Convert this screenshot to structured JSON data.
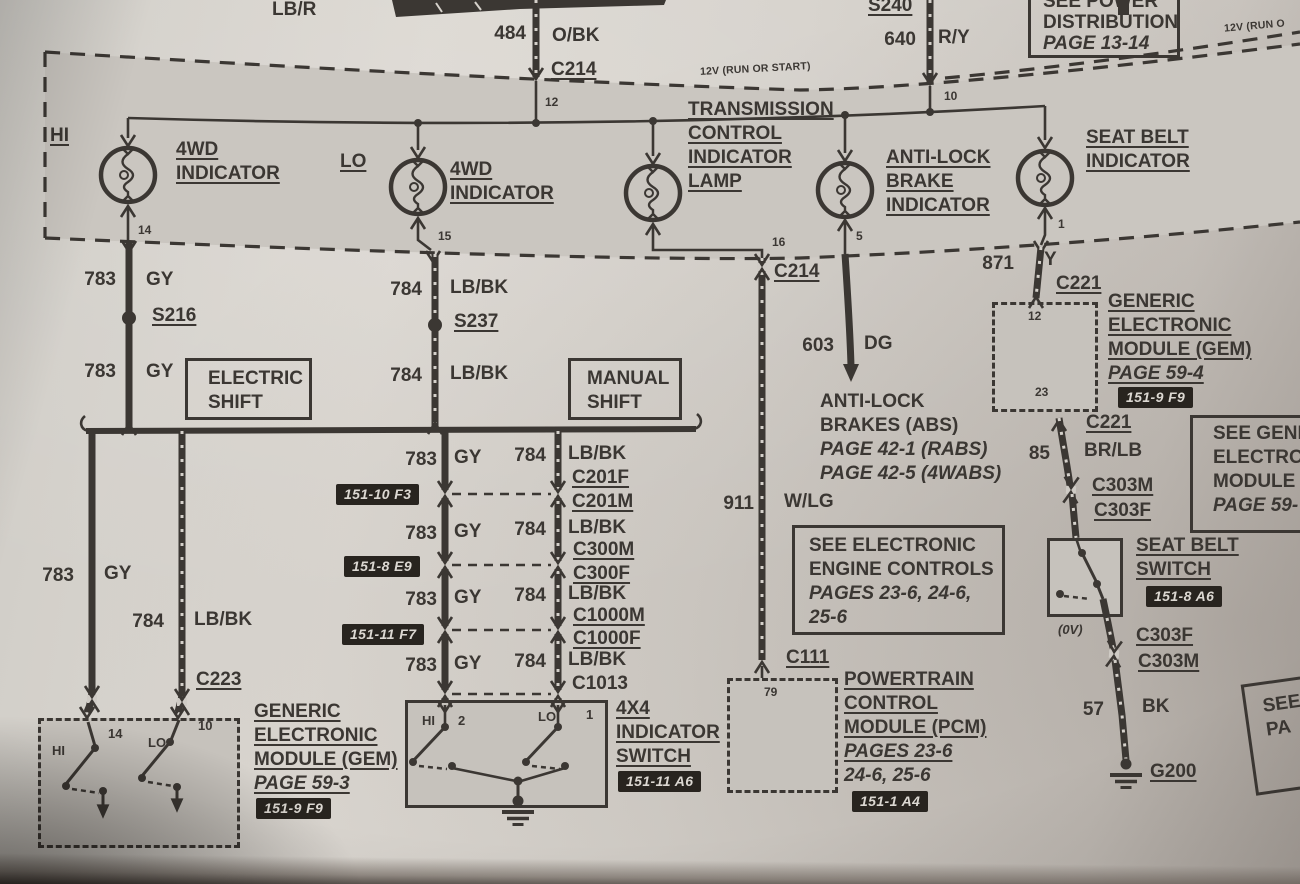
{
  "palette": {
    "paper": "#d7d3cd",
    "ink": "#3b3733",
    "panel": "#c6c2bc",
    "badge_bg": "#28241f",
    "badge_text": "#dcd8d2"
  },
  "top": {
    "lb_r": "LB/R",
    "s240": "S240",
    "w484_num": "484",
    "w484_color": "O/BK",
    "c214": "C214",
    "w640_num": "640",
    "w640_color": "R/Y",
    "power_box": [
      "SEE POWER",
      "DISTRIBUTION",
      "PAGE 13-14"
    ],
    "feed_left": "12V (RUN OR START)",
    "feed_right": "12V (RUN O"
  },
  "cluster": {
    "pin12": "12",
    "pin10": "10",
    "pin14": "14",
    "pin15": "15",
    "pin16": "16",
    "pin5": "5",
    "pin1": "1",
    "hi": "HI",
    "lo": "LO",
    "lamp_4wd_hi": [
      "4WD",
      "INDICATOR"
    ],
    "lamp_4wd_lo": [
      "4WD",
      "INDICATOR"
    ],
    "lamp_trans": [
      "TRANSMISSION",
      "CONTROL",
      "INDICATOR",
      "LAMP"
    ],
    "od_off": [
      "O/D",
      "OFF"
    ],
    "lamp_abs": [
      "ANTI-LOCK",
      "BRAKE",
      "INDICATOR"
    ],
    "lamp_belt": [
      "SEAT BELT",
      "INDICATOR"
    ]
  },
  "left": {
    "w783a_num": "783",
    "w783a_color": "GY",
    "s216": "S216",
    "w783b_num": "783",
    "w783b_color": "GY",
    "electric_shift": [
      "ELECTRIC",
      "SHIFT"
    ],
    "w784a_num": "784",
    "w784a_color": "LB/BK",
    "s237": "S237",
    "w784b_num": "784",
    "w784b_color": "LB/BK",
    "manual_shift": [
      "MANUAL",
      "SHIFT"
    ],
    "w783v_num": "783",
    "w783v_color": "GY",
    "w784v_num": "784",
    "w784v_color": "LB/BK",
    "c223": "C223"
  },
  "stack": {
    "rows": [
      {
        "nl": "783",
        "cl": "GY",
        "nr": "784",
        "cr": "LB/BK",
        "ctop": "C201F",
        "cbot": "C201M",
        "badge": "151-10 F3"
      },
      {
        "nl": "783",
        "cl": "GY",
        "nr": "784",
        "cr": "LB/BK",
        "ctop": "C300M",
        "cbot": "C300F",
        "badge": "151-8 E9"
      },
      {
        "nl": "783",
        "cl": "GY",
        "nr": "784",
        "cr": "LB/BK",
        "ctop": "C1000M",
        "cbot": "C1000F",
        "badge": "151-11 F7"
      },
      {
        "nl": "783",
        "cl": "GY",
        "nr": "784",
        "cr": "LB/BK",
        "ctop": "C1013"
      }
    ]
  },
  "center": {
    "c214": "C214",
    "w603_num": "603",
    "w603_color": "DG",
    "abs_text": [
      "ANTI-LOCK",
      "BRAKES (ABS)",
      "PAGE 42-1 (RABS)",
      "PAGE 42-5 (4WABS)"
    ],
    "w911_num": "911",
    "w911_color": "W/LG",
    "eec_box": [
      "SEE ELECTRONIC",
      "ENGINE CONTROLS",
      "PAGES 23-6, 24-6,",
      "25-6"
    ],
    "c111": "C111",
    "pcm_pin": "79",
    "pcm": [
      "POWERTRAIN",
      "CONTROL",
      "MODULE (PCM)",
      "PAGES 23-6",
      "24-6, 25-6"
    ],
    "pcm_badge": "151-1 A4"
  },
  "right": {
    "w871_num": "871",
    "w871_color": "Y",
    "c221_top": "C221",
    "gem_pin12": "12",
    "gem_pin23": "23",
    "gem": [
      "GENERIC",
      "ELECTRONIC",
      "MODULE (GEM)",
      "PAGE 59-4"
    ],
    "gem_badge": "151-9 F9",
    "c221_bottom": "C221",
    "w85_num": "85",
    "w85_color": "BR/LB",
    "c303m_upper": "C303M",
    "c303f_upper": "C303F",
    "see_gem_box": [
      "SEE GENE",
      "ELECTRO",
      "MODULE",
      "PAGE 59-"
    ],
    "belt_switch": [
      "SEAT BELT",
      "SWITCH"
    ],
    "belt_badge": "151-8 A6",
    "ov": "(0V)",
    "c303f_lower": "C303F",
    "c303m_lower": "C303M",
    "w57_num": "57",
    "w57_color": "BK",
    "g200": "G200",
    "see_pa_box": [
      "SEE",
      "PA"
    ]
  },
  "bottom_left": {
    "hi": "HI",
    "pin14": "14",
    "lo": "LO",
    "pin10": "10",
    "gem": [
      "GENERIC",
      "ELECTRONIC",
      "MODULE (GEM)",
      "PAGE 59-3"
    ],
    "gem_badge": "151-9 F9"
  },
  "switch4x4": {
    "hi": "HI",
    "pin2": "2",
    "lo": "LO",
    "pin1": "1",
    "label": [
      "4X4",
      "INDICATOR",
      "SWITCH"
    ],
    "badge": "151-11 A6"
  }
}
